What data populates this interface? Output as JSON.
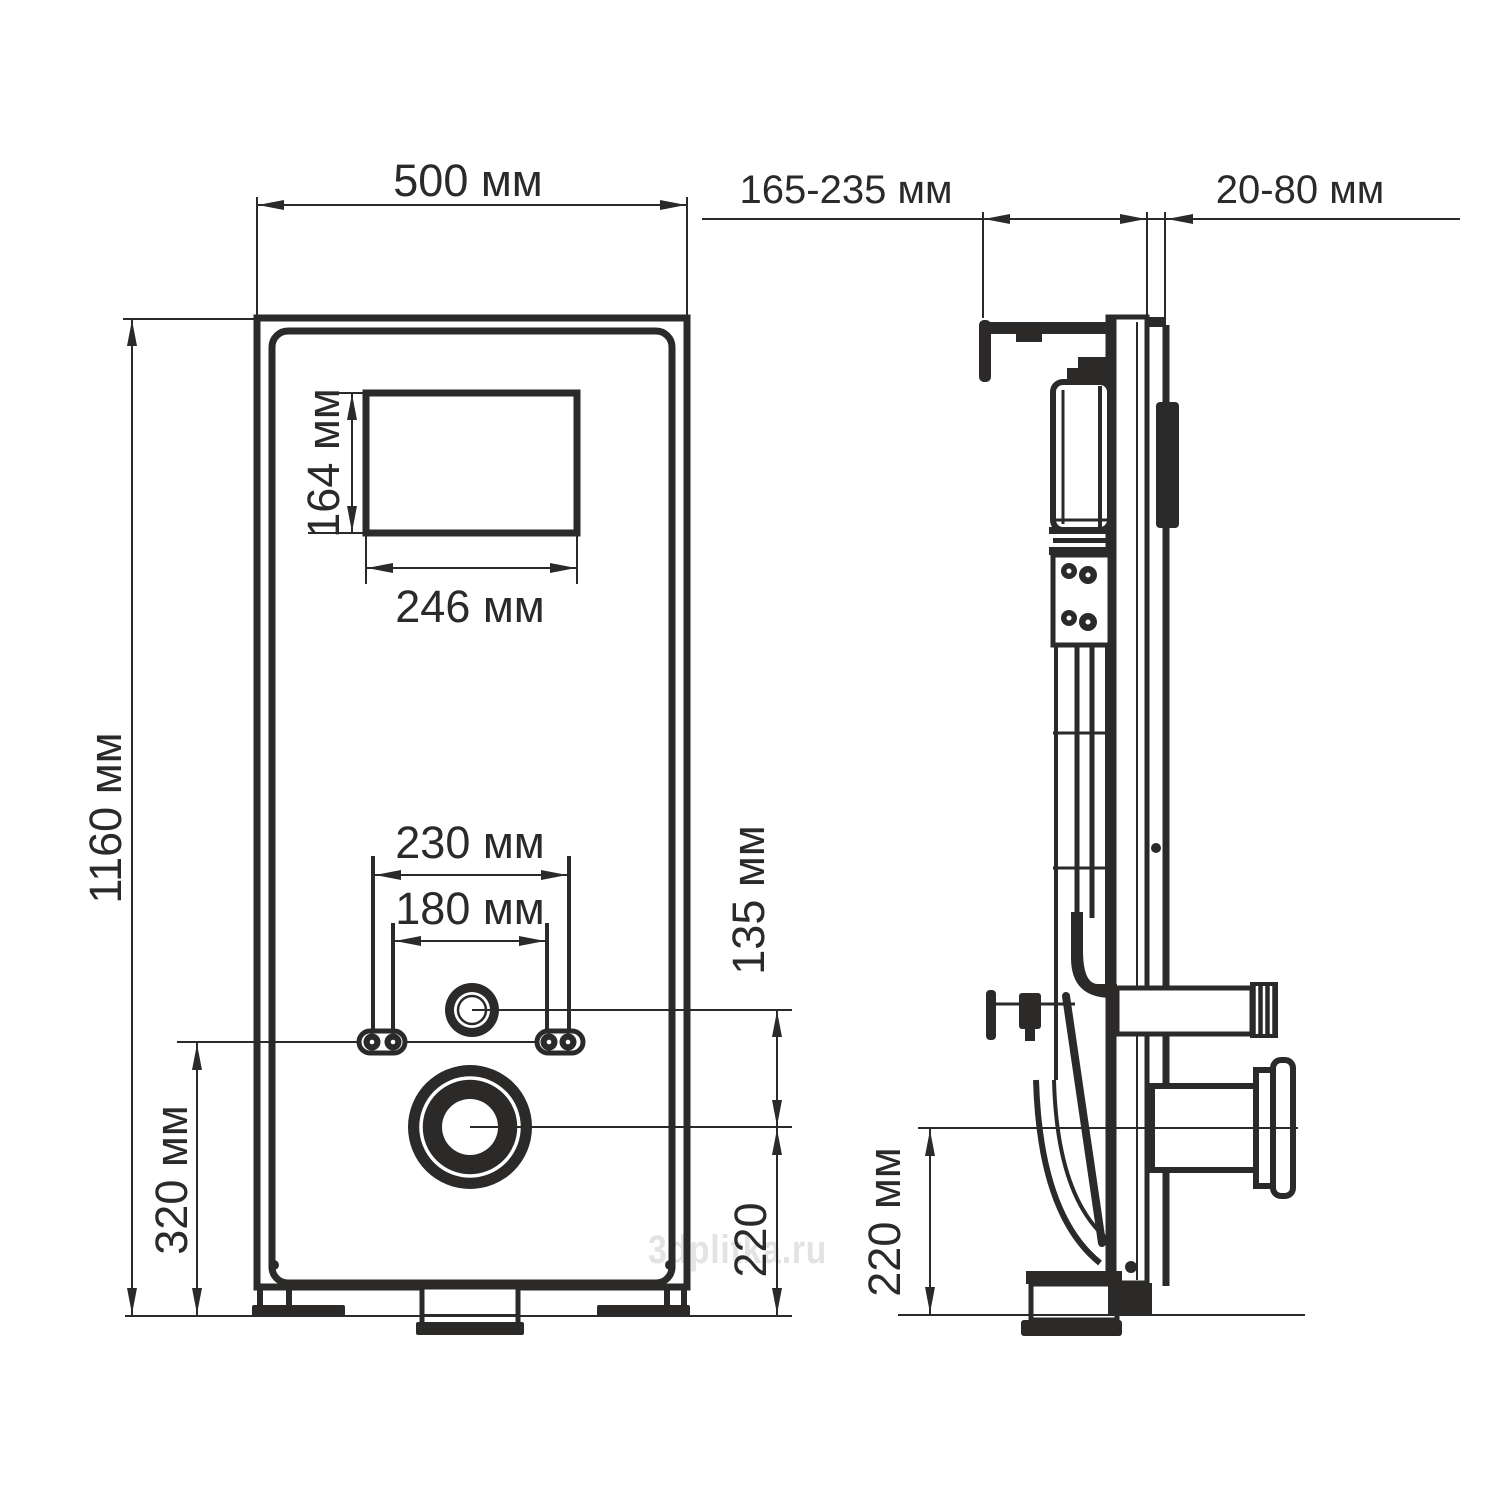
{
  "colors": {
    "ink": "#2b2a29",
    "watermark": "#e3e3e3",
    "background": "#ffffff"
  },
  "watermark": {
    "text": "3dplitka.ru"
  },
  "front_view": {
    "labels": {
      "panel_width": "500 мм",
      "panel_height": "1160 мм",
      "opening_height": "164 мм",
      "opening_width": "246 мм",
      "bolt_span_outer": "230 мм",
      "bolt_span_inner": "180 мм",
      "inlet_to_outlet": "135 мм",
      "bolt_line_to_floor": "320 мм",
      "outlet_to_floor": "220"
    }
  },
  "side_view": {
    "labels": {
      "mounting_depth": "165-235 мм",
      "wall_finish_thickness": "20-80 мм",
      "outlet_height": "220 мм"
    }
  }
}
